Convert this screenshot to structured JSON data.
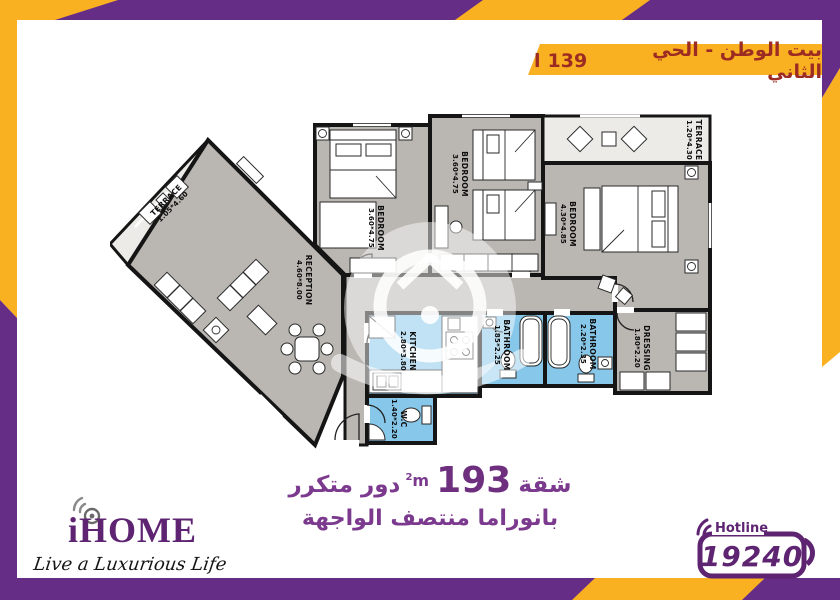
{
  "header": {
    "title": "بيت الوطن - الحي الثاني",
    "unit_number": "139",
    "unit_suffix": "l"
  },
  "floor_plan": {
    "rooms": {
      "terrace1": {
        "name": "TERRACE",
        "dims": "1.05*4.60"
      },
      "reception": {
        "name": "RECEPTION",
        "dims": "4.60*8.00"
      },
      "bedroom1": {
        "name": "BEDROOM",
        "dims": "3.60*4.75"
      },
      "bedroom2": {
        "name": "BEDROOM",
        "dims": "3.60*4.75"
      },
      "terrace2": {
        "name": "TERRACE",
        "dims": "1.20*4.30"
      },
      "bedroom3": {
        "name": "BEDROOM",
        "dims": "4.30*4.85"
      },
      "kitchen": {
        "name": "KITCHEN",
        "dims": "2.80*3.80"
      },
      "bathroom1": {
        "name": "BATHROOM",
        "dims": "1.85*2.25"
      },
      "bathroom2": {
        "name": "BATHROOM",
        "dims": "2.20*2.35"
      },
      "dressing": {
        "name": "DRESSING",
        "dims": "1.80*2.20"
      },
      "wc": {
        "name": "W.C",
        "dims": "1.40*2.20"
      }
    }
  },
  "footer": {
    "area_prefix": "شقة",
    "area_value": "193",
    "area_unit": "m",
    "area_sup": "2",
    "area_suffix": "دور متكرر",
    "line2": "بانوراما منتصف الواجهة"
  },
  "logo": {
    "name": "iHOME",
    "tagline": "Live a Luxurious Life"
  },
  "hotline": {
    "label": "Hotline",
    "number": "19240"
  },
  "colors": {
    "accent_yellow": "#F9B021",
    "brand_purple": "#662D87",
    "banner_text": "#9C2B23",
    "footer_purple": "#7B3A8E",
    "plan_wall": "#151515",
    "plan_floor": "#BAB7B2",
    "plan_wet_blue": "#87C7EA",
    "plan_terrace": "#EDEBE7"
  }
}
